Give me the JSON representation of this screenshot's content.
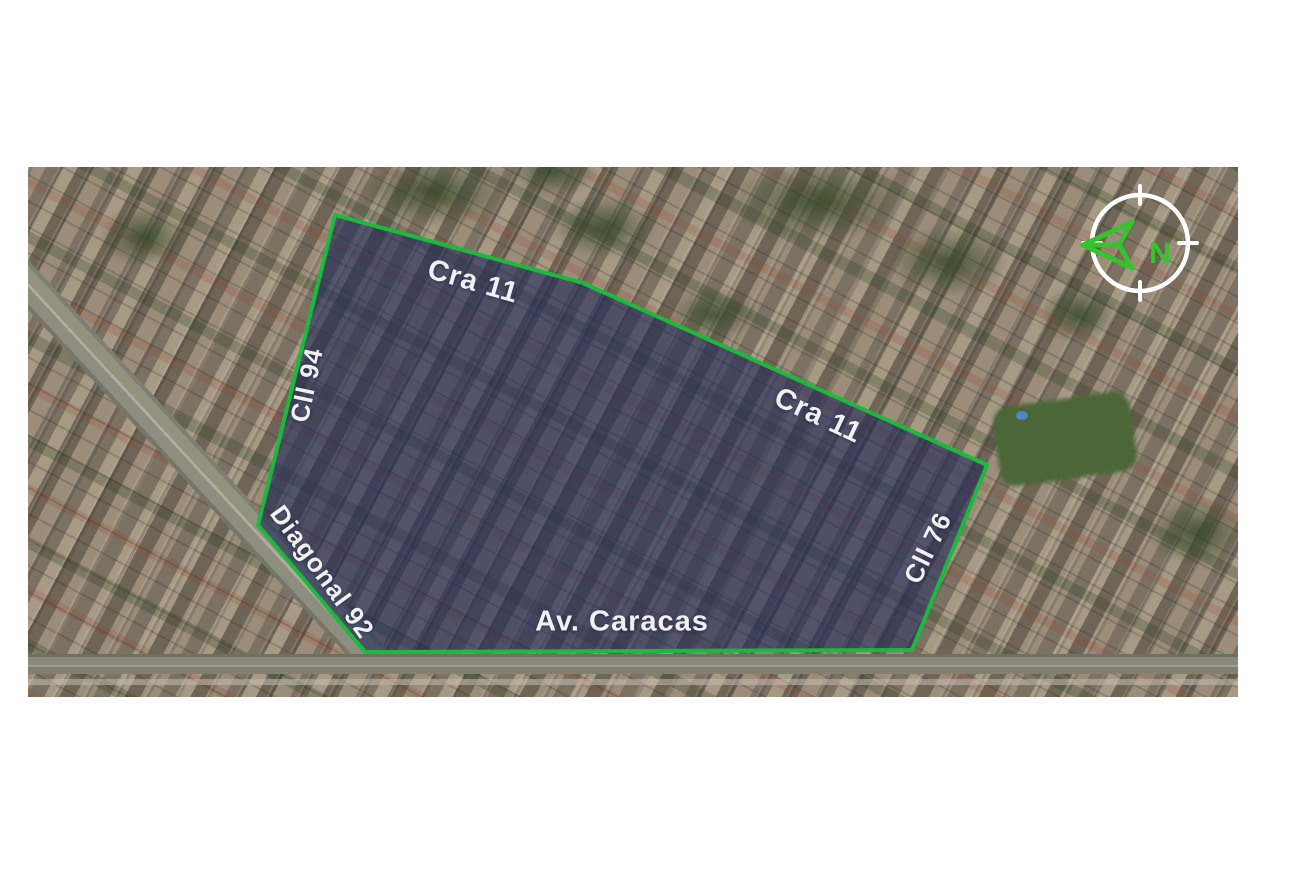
{
  "map": {
    "street_labels": [
      {
        "name": "cra-11-top",
        "text": "Cra 11"
      },
      {
        "name": "cll-94",
        "text": "Cll 94"
      },
      {
        "name": "cra-11-right",
        "text": "Cra 11"
      },
      {
        "name": "diagonal-92",
        "text": "Diagonal 92"
      },
      {
        "name": "av-caracas",
        "text": "Av. Caracas"
      },
      {
        "name": "cll-76",
        "text": "Cll 76"
      }
    ],
    "compass": {
      "north_label": "N"
    },
    "colors": {
      "boundary_stroke": "#1db93c",
      "highlight_fill": "rgba(32,42,88,0.62)",
      "compass_green": "#35c42e",
      "label_text": "#ffffff",
      "compass_ring": "#ffffff"
    }
  }
}
